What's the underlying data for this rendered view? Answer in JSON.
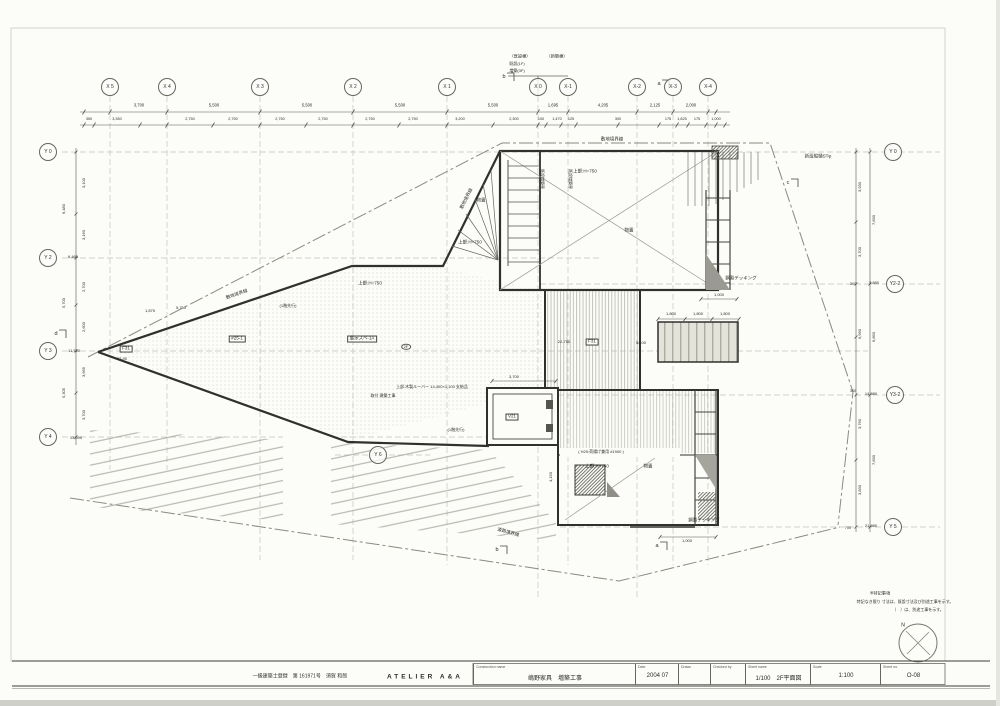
{
  "colors": {
    "paper": "#fcfcf9",
    "ink": "#2c2c28",
    "grid": "#c2c2bd",
    "hatch": "#9d9d95"
  },
  "axes": {
    "top": [
      {
        "label": "X 5",
        "x": 110,
        "y": 87
      },
      {
        "label": "X 4",
        "x": 167,
        "y": 87
      },
      {
        "label": "X 3",
        "x": 260,
        "y": 87
      },
      {
        "label": "X 2",
        "x": 353,
        "y": 87
      },
      {
        "label": "X 1",
        "x": 447,
        "y": 87
      },
      {
        "label": "X 0",
        "x": 538,
        "y": 87
      },
      {
        "label": "X-1",
        "x": 568,
        "y": 87
      },
      {
        "label": "X-2",
        "x": 637,
        "y": 87
      },
      {
        "label": "X-3",
        "x": 673,
        "y": 87
      },
      {
        "label": "X-4",
        "x": 708,
        "y": 87
      }
    ],
    "left": [
      {
        "label": "Y 0",
        "x": 48,
        "y": 152
      },
      {
        "label": "Y 2",
        "x": 48,
        "y": 258
      },
      {
        "label": "Y 3",
        "x": 48,
        "y": 351
      },
      {
        "label": "Y 4",
        "x": 48,
        "y": 437
      }
    ],
    "right": [
      {
        "label": "Y 0",
        "x": 893,
        "y": 152
      },
      {
        "label": "Y2-2",
        "x": 895,
        "y": 284
      },
      {
        "label": "Y3-2",
        "x": 895,
        "y": 395
      },
      {
        "label": "Y 5",
        "x": 893,
        "y": 527
      }
    ],
    "inner": [
      {
        "label": "Y 6",
        "x": 378,
        "y": 455
      }
    ]
  },
  "dims": {
    "top_row1": [
      {
        "t": "3,700",
        "x": 139,
        "y": 106,
        "s": 4.2
      },
      {
        "t": "5,500",
        "x": 214,
        "y": 106,
        "s": 4.2
      },
      {
        "t": "5,500",
        "x": 307,
        "y": 106,
        "s": 4.2
      },
      {
        "t": "5,500",
        "x": 400,
        "y": 106,
        "s": 4.2
      },
      {
        "t": "5,500",
        "x": 493,
        "y": 106,
        "s": 4.2
      },
      {
        "t": "1,695",
        "x": 553,
        "y": 106,
        "s": 4.2
      },
      {
        "t": "4,205",
        "x": 603,
        "y": 106,
        "s": 4.2
      },
      {
        "t": "2,125",
        "x": 655,
        "y": 106,
        "s": 4.2
      },
      {
        "t": "2,000",
        "x": 691,
        "y": 106,
        "s": 4.2
      }
    ],
    "top_row2": [
      {
        "t": "350",
        "x": 89,
        "y": 119,
        "s": 3.8
      },
      {
        "t": "3,350",
        "x": 117,
        "y": 119,
        "s": 3.8
      },
      {
        "t": "2,750",
        "x": 190,
        "y": 119,
        "s": 3.8
      },
      {
        "t": "2,750",
        "x": 233,
        "y": 119,
        "s": 3.8
      },
      {
        "t": "2,750",
        "x": 280,
        "y": 119,
        "s": 3.8
      },
      {
        "t": "2,750",
        "x": 323,
        "y": 119,
        "s": 3.8
      },
      {
        "t": "2,750",
        "x": 370,
        "y": 119,
        "s": 3.8
      },
      {
        "t": "2,750",
        "x": 413,
        "y": 119,
        "s": 3.8
      },
      {
        "t": "3,200",
        "x": 460,
        "y": 119,
        "s": 3.8
      },
      {
        "t": "2,300",
        "x": 514,
        "y": 119,
        "s": 3.8
      },
      {
        "t": "100",
        "x": 541,
        "y": 119,
        "s": 3.8
      },
      {
        "t": "1,470",
        "x": 557,
        "y": 119,
        "s": 3.8
      },
      {
        "t": "125",
        "x": 571,
        "y": 119,
        "s": 3.8
      },
      {
        "t": "300",
        "x": 618,
        "y": 119,
        "s": 3.8
      },
      {
        "t": "175",
        "x": 668,
        "y": 119,
        "s": 3.8
      },
      {
        "t": "1,825",
        "x": 682,
        "y": 119,
        "s": 3.8
      },
      {
        "t": "175",
        "x": 697,
        "y": 119,
        "s": 3.8
      },
      {
        "t": "1,000",
        "x": 716,
        "y": 119,
        "s": 3.8
      }
    ],
    "left": [
      {
        "t": "3,100",
        "x": 84,
        "y": 183,
        "rot": -90,
        "s": 4
      },
      {
        "t": "6,480",
        "x": 64,
        "y": 209,
        "rot": -90,
        "s": 4
      },
      {
        "t": "3,160",
        "x": 84,
        "y": 235,
        "rot": -90,
        "s": 4
      },
      {
        "t": "2,700",
        "x": 84,
        "y": 287,
        "rot": -90,
        "s": 4
      },
      {
        "t": "5,700",
        "x": 64,
        "y": 303,
        "rot": -90,
        "s": 4
      },
      {
        "t": "2,600",
        "x": 84,
        "y": 327,
        "rot": -90,
        "s": 4
      },
      {
        "t": "3,665",
        "x": 84,
        "y": 372,
        "rot": -90,
        "s": 4
      },
      {
        "t": "5,305",
        "x": 64,
        "y": 393,
        "rot": -90,
        "s": 4
      },
      {
        "t": "3,700",
        "x": 84,
        "y": 415,
        "rot": -90,
        "s": 4
      }
    ],
    "right": [
      {
        "t": "3,930",
        "x": 860,
        "y": 187,
        "rot": -90,
        "s": 4
      },
      {
        "t": "7,830",
        "x": 874,
        "y": 220,
        "rot": -90,
        "s": 4
      },
      {
        "t": "3,700",
        "x": 860,
        "y": 252,
        "rot": -90,
        "s": 4
      },
      {
        "t": "6,990",
        "x": 860,
        "y": 334,
        "rot": -90,
        "s": 4
      },
      {
        "t": "6,890",
        "x": 874,
        "y": 337,
        "rot": -90,
        "s": 4
      },
      {
        "t": "3,760",
        "x": 860,
        "y": 424,
        "rot": -90,
        "s": 4
      },
      {
        "t": "7,830",
        "x": 874,
        "y": 460,
        "rot": -90,
        "s": 4
      },
      {
        "t": "3,830",
        "x": 860,
        "y": 490,
        "rot": -90,
        "s": 4
      }
    ]
  },
  "plan_labels": [
    {
      "t": "敷地境界線",
      "x": 237,
      "y": 295,
      "rot": -19,
      "s": 4.5
    },
    {
      "t": "敷地境界線",
      "x": 467,
      "y": 199,
      "rot": -63,
      "s": 4.5
    },
    {
      "t": "敷地境界線",
      "x": 612,
      "y": 140,
      "s": 4.5
    },
    {
      "t": "道路境界線",
      "x": 508,
      "y": 533,
      "rot": 16,
      "s": 4.5
    },
    {
      "t": "上部:H=750",
      "x": 585,
      "y": 172,
      "s": 4.5
    },
    {
      "t": "物置",
      "x": 629,
      "y": 231,
      "s": 4.5
    },
    {
      "t": "上部:H=750",
      "x": 470,
      "y": 243,
      "s": 4.5
    },
    {
      "t": "物置",
      "x": 481,
      "y": 201,
      "s": 4.5
    },
    {
      "t": "上部:H=750",
      "x": 370,
      "y": 284,
      "s": 4.5
    },
    {
      "t": "上部:H=750",
      "x": 597,
      "y": 467,
      "s": 4.5
    },
    {
      "t": "物置",
      "x": 648,
      "y": 467,
      "s": 4.5
    },
    {
      "t": "F31",
      "x": 126,
      "y": 349,
      "cls": "boxed",
      "s": 4.5
    },
    {
      "t": "22-90",
      "x": 122,
      "y": 359,
      "s": 4
    },
    {
      "t": "#25-1",
      "x": 237,
      "y": 339,
      "cls": "boxed",
      "s": 4.5
    },
    {
      "t": "展示スペ-1A",
      "x": 362,
      "y": 339,
      "cls": "boxed",
      "s": 4.5
    },
    {
      "t": "2F",
      "x": 406,
      "y": 347,
      "cls": "bubble",
      "s": 4
    },
    {
      "t": "22-750",
      "x": 564,
      "y": 342,
      "s": 4
    },
    {
      "t": "F31",
      "x": 592,
      "y": 342,
      "cls": "boxed",
      "s": 4.5
    },
    {
      "t": "V21",
      "x": 512,
      "y": 417,
      "cls": "boxed",
      "s": 4.5
    },
    {
      "t": "上部:木製ルーバー 14,400×1,100 支給品",
      "x": 432,
      "y": 387,
      "s": 4
    },
    {
      "t": "取付 建築工事",
      "x": 383,
      "y": 396,
      "s": 4
    },
    {
      "t": "(1階先行)",
      "x": 288,
      "y": 306,
      "s": 4
    },
    {
      "t": "(1階先行)",
      "x": 456,
      "y": 430,
      "s": 4
    },
    {
      "t": "( H25:荷揚げ兼用 #1900 )",
      "x": 601,
      "y": 452,
      "s": 4
    },
    {
      "t": "新設縦樋STφ",
      "x": 818,
      "y": 157,
      "s": 4.5
    },
    {
      "t": "鋼製デッキング",
      "x": 741,
      "y": 279,
      "s": 4.5
    },
    {
      "t": "鋼製デッキング",
      "x": 704,
      "y": 521,
      "s": 4.5
    },
    {
      "t": "既設増築界",
      "x": 542,
      "y": 179,
      "rot": 90,
      "s": 4
    },
    {
      "t": "既設増築界",
      "x": 570,
      "y": 179,
      "rot": 90,
      "s": 4
    },
    {
      "t": "3,700",
      "x": 514,
      "y": 377,
      "s": 4
    },
    {
      "t": "1,000",
      "x": 719,
      "y": 295,
      "s": 4
    },
    {
      "t": "1,000",
      "x": 687,
      "y": 541,
      "s": 4
    },
    {
      "t": "4,150",
      "x": 551,
      "y": 477,
      "rot": -90,
      "s": 4
    },
    {
      "t": "5/100",
      "x": 641,
      "y": 343,
      "s": 4
    },
    {
      "t": "1,800",
      "x": 671,
      "y": 314,
      "s": 4
    },
    {
      "t": "1,800",
      "x": 698,
      "y": 314,
      "s": 4
    },
    {
      "t": "1,800",
      "x": 725,
      "y": 314,
      "s": 4
    },
    {
      "t": "1,875",
      "x": 150,
      "y": 311,
      "s": 4
    },
    {
      "t": "5,750",
      "x": 181,
      "y": 308,
      "s": 4
    },
    {
      "t": "6,465",
      "x": 73,
      "y": 257,
      "s": 4
    },
    {
      "t": "11,750",
      "x": 74,
      "y": 351,
      "s": 4
    },
    {
      "t": "13,090",
      "x": 76,
      "y": 438,
      "s": 4
    },
    {
      "t": "3,880",
      "x": 874,
      "y": 283,
      "s": 4
    },
    {
      "t": "14,380",
      "x": 871,
      "y": 394,
      "s": 4
    },
    {
      "t": "21,980",
      "x": 871,
      "y": 526,
      "s": 4
    },
    {
      "t": "300",
      "x": 853,
      "y": 284,
      "s": 3.8
    },
    {
      "t": "300",
      "x": 853,
      "y": 391,
      "s": 3.8
    },
    {
      "t": "700",
      "x": 848,
      "y": 528,
      "s": 3.8
    },
    {
      "t": "〈既設棟〉",
      "x": 520,
      "y": 57,
      "s": 4.2
    },
    {
      "t": "〈新築棟〉",
      "x": 557,
      "y": 57,
      "s": 4.2
    },
    {
      "t": "既設(1F)",
      "x": 517,
      "y": 64,
      "s": 4
    },
    {
      "t": "増築(3F)",
      "x": 517,
      "y": 71,
      "s": 4
    },
    {
      "t": "b",
      "x": 504,
      "y": 77,
      "s": 5.5
    },
    {
      "t": "a",
      "x": 659,
      "y": 84,
      "s": 5.5
    },
    {
      "t": "d",
      "x": 56,
      "y": 334,
      "s": 5.5
    },
    {
      "t": "c",
      "x": 788,
      "y": 183,
      "s": 5.5
    },
    {
      "t": "b",
      "x": 497,
      "y": 550,
      "s": 5.5
    },
    {
      "t": "a",
      "x": 657,
      "y": 546,
      "s": 5.5
    },
    {
      "t": "N",
      "x": 903,
      "y": 626,
      "s": 5
    },
    {
      "t": "※特記事項",
      "x": 880,
      "y": 594,
      "s": 4.2
    },
    {
      "t": "特記なき限り 寸法は、既設寸法及び別途工事を示す。",
      "x": 905,
      "y": 602,
      "s": 4
    },
    {
      "t": "（　）は、別途工事を示す。",
      "x": 918,
      "y": 610,
      "s": 4
    }
  ],
  "title_block": {
    "registration": "一級建築士登録　第 161971号　須賀 和郎",
    "firm": "ATELIER A&A",
    "fields": [
      {
        "label": "Construction name",
        "value": "嶋野家具　増築工事",
        "x": 473,
        "w": 162,
        "abs": true
      },
      {
        "label": "Date",
        "value": "2004 07",
        "x": 635,
        "w": 43,
        "abs": true
      },
      {
        "label": "Drawn",
        "value": "",
        "x": 678,
        "w": 32,
        "abs": true
      },
      {
        "label": "Checked by",
        "value": "",
        "x": 710,
        "w": 35,
        "abs": true
      },
      {
        "label": "Sheet name",
        "value": "1/100　2F平面図",
        "x": 745,
        "w": 65,
        "abs": true
      },
      {
        "label": "Scale",
        "value": "1:100",
        "x": 810,
        "w": 70,
        "abs": true
      },
      {
        "label": "Sheet no.",
        "value": "O-08",
        "x": 880,
        "w": 65,
        "abs": true
      }
    ]
  }
}
